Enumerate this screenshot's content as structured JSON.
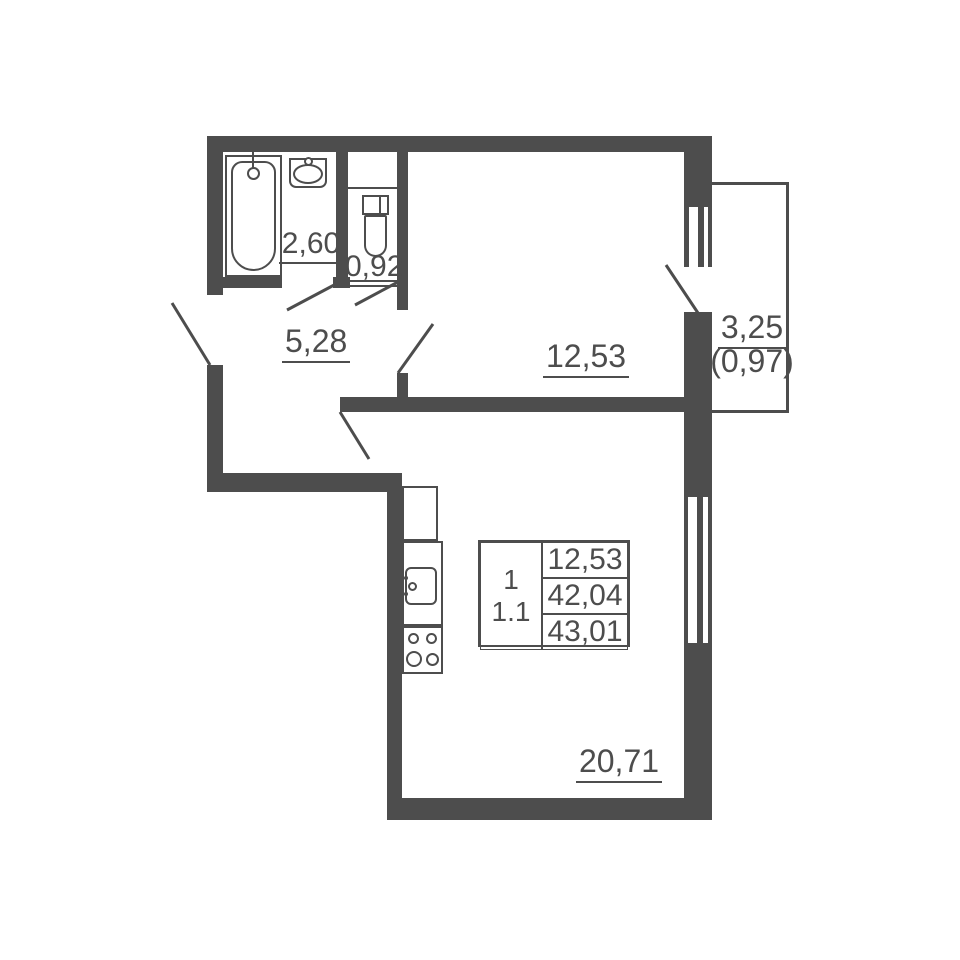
{
  "floor_plan": {
    "rooms": {
      "bathroom": {
        "area": "2,60"
      },
      "toilet": {
        "area": "0,92"
      },
      "hallway": {
        "area": "5,28"
      },
      "bedroom": {
        "area": "12,53"
      },
      "living_kitchen": {
        "area": "20,71"
      },
      "balcony": {
        "area": "3,25",
        "area_coefficient": "(0,97)"
      }
    },
    "stamp": {
      "rooms_count": "1",
      "unit_code": "1.1",
      "living_area": "12,53",
      "area_without_balcony": "42,04",
      "total_area": "43,01"
    },
    "colors": {
      "wall": "#4d4d4d",
      "background": "#ffffff"
    }
  }
}
